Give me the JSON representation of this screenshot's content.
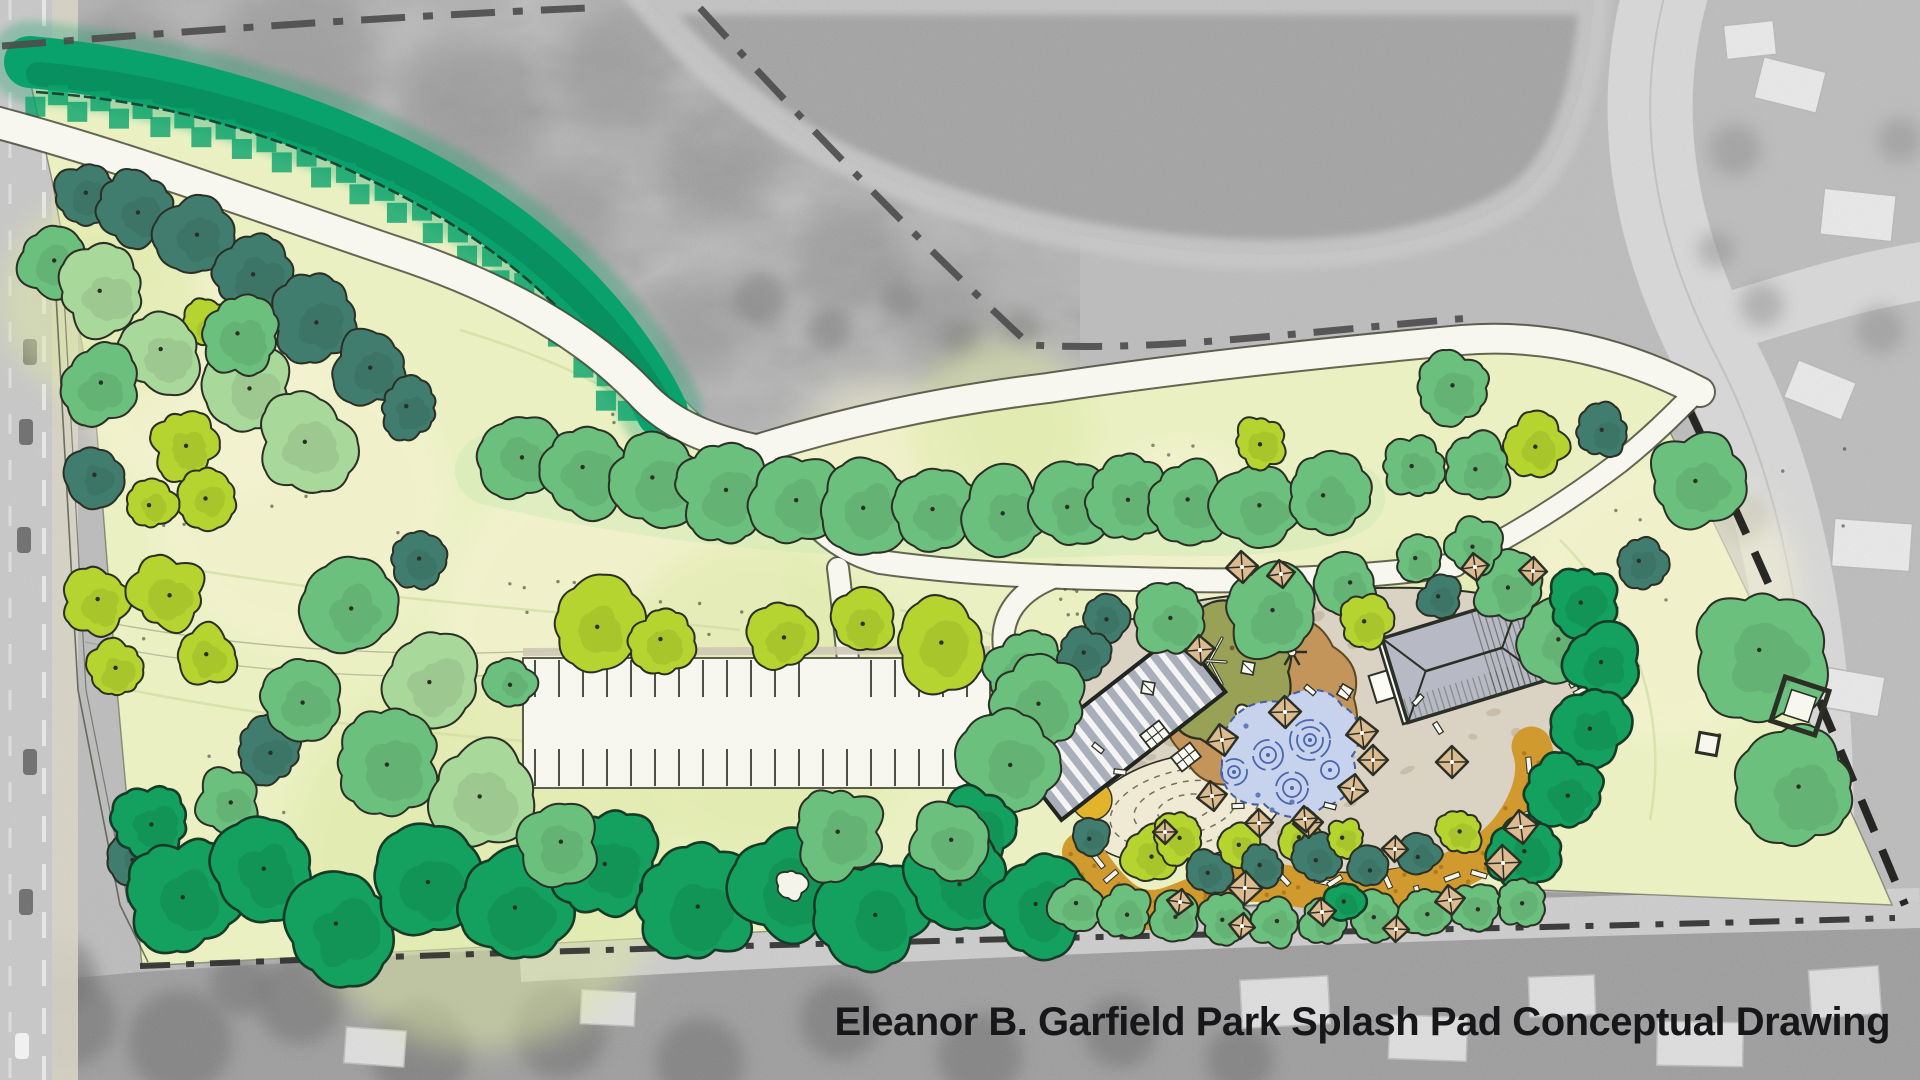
{
  "title": {
    "text": "Eleanor B. Garfield Park Splash Pad Conceptual Drawing"
  },
  "palette": {
    "base_gray": "#bcbcbc",
    "forest_gray": "#b0b0b0",
    "pond_gray": "#a3a3a3",
    "shore_gray": "#c9c9c9",
    "road_gray": "#d8d8d8",
    "road_left": "#c8c8c8",
    "sidewalk": "#d9d6c6",
    "bottom_gray": "#9c9c9c",
    "gray_tree": "#6f6f6f",
    "house_gray": "#e9e9e9",
    "house_edge": "#b8b8b8",
    "lawn": "#eaf0c2",
    "lawn_light": "#f5f3d4",
    "lawn_wash": "#dce8a4",
    "lawn_line": "#cfdd9f",
    "ink": "#2b2f25",
    "boundary_gray": "#4b4b4b",
    "shore_dash": "#7e7e7e",
    "path_fill": "#f7f7ef",
    "path_edge": "#4b4e3c",
    "emerald": "#0aa26c",
    "emerald_dark": "#067a51",
    "tree_light": "#a9d89b",
    "tree_medium": "#6cc07d",
    "tree_deep": "#14a05e",
    "tree_teal": "#417d6e",
    "tree_chartreuse": "#b5d430",
    "plaza_tan": "#dad2c2",
    "plaza_dot": "#c2b8a4",
    "sand_brown": "#c3955a",
    "mound_olive": "#99a156",
    "mulch_orange": "#d09a2e",
    "mulch_dot": "#a8771a",
    "amber_patch": "#e3b32b",
    "water_blue": "#c7d2ec",
    "water_line": "#4a67ad",
    "umbrella_tan": "#dcbb90",
    "table_white": "#fbfbf5",
    "roof_gray": "#b7bac4",
    "pergola_gray": "#a9aebb",
    "contour_cream": "#f0ead4",
    "contour_line": "#70745c",
    "title_color": "#17171a"
  },
  "map": {
    "canvas": {
      "w": 1920,
      "h": 1080
    },
    "pond": {
      "d": "M646,0 C690,55 745,105 820,148 C930,205 1060,240 1200,252 C1330,262 1445,245 1515,200 C1562,168 1588,95 1594,0 Z"
    },
    "lawn": {
      "d": "M30,80 C180,92 330,140 455,205 C545,252 615,315 668,382 C700,420 730,440 762,452 C880,412 960,396 1048,386 C1180,364 1320,354 1462,340 C1560,332 1642,362 1706,394 L1668,428 C1760,620 1830,760 1892,905 L1540,890 C1100,910 560,946 142,966 L118,700 L96,420 L52,180 Z"
    },
    "emerald_band": {
      "core": "M30,62 C160,74 290,110 400,165 C495,212 560,268 610,330 C635,362 652,390 662,412",
      "squiggle": "M36,92 C180,102 300,142 402,196 C492,243 552,295 600,355 C622,382 638,402 650,420"
    },
    "boundaries": [
      {
        "d": "M2,46 C200,30 400,16 588,8",
        "w": 7,
        "dash": "44 18 10 18",
        "c": "#4b4b4b",
        "o": 0.9
      },
      {
        "d": "M700,8 C810,130 940,262 1030,345 C1160,352 1300,332 1470,318",
        "w": 7,
        "dash": "40 18 8 18",
        "c": "#4b4b4b",
        "o": 0.9
      },
      {
        "d": "M1000,386 L1262,362",
        "w": 5,
        "dash": "46 16 10 16",
        "c": "#7e7e7e",
        "o": 0.8
      },
      {
        "d": "M1687,405 C1760,560 1820,700 1905,905",
        "w": 8,
        "dash": "34 20",
        "c": "#1d1f1a",
        "o": 0.95
      },
      {
        "d": "M140,966 C500,952 800,944 1100,937 C1400,930 1700,924 1895,918",
        "w": 6,
        "dash": "30 16 8 16",
        "c": "#2e2e2e",
        "o": 0.9
      },
      {
        "d": "M56,295 L78,690 L120,905 L148,962",
        "w": 1.6,
        "dash": "",
        "c": "#4b4e3c",
        "o": 0.75
      },
      {
        "d": "M64,295 L86,690 L128,903",
        "w": 1.2,
        "dash": "",
        "c": "#4b4e3c",
        "o": 0.6
      }
    ],
    "paths": [
      {
        "d": "M-5,122 C130,158 270,210 395,252 C505,288 585,335 640,392 C665,420 700,438 755,450",
        "w": 30
      },
      {
        "d": "M755,450 C850,420 950,400 1048,388 C1180,368 1330,352 1462,340 C1560,332 1642,362 1700,392",
        "w": 28
      },
      {
        "d": "M755,450 C795,505 825,548 880,562 C980,576 1080,578 1180,580 C1280,582 1380,576 1455,565",
        "w": 22
      },
      {
        "d": "M1455,565 C1520,532 1570,500 1620,462 C1650,438 1672,416 1690,398",
        "w": 20
      },
      {
        "d": "M838,568 C842,600 845,630 848,660",
        "w": 20
      },
      {
        "d": "M1058,576 C1018,590 1000,616 1004,648 C1008,682 1024,706 1050,724",
        "w": 20
      }
    ],
    "parking": {
      "x": 523,
      "y": 658,
      "w": 467,
      "h": 130,
      "tick_step": 24,
      "top_ticks": [
        660,
        697
      ],
      "bottom_ticks": [
        749,
        786
      ],
      "entry_gap": [
        806,
        852
      ]
    },
    "plaza": {
      "d": "M1140,618 C1180,600 1240,592 1310,592 C1390,585 1470,585 1530,605 C1566,625 1582,665 1578,710 C1570,762 1540,802 1498,832 C1448,862 1388,876 1328,872 C1258,880 1188,866 1140,838 C1092,810 1060,768 1054,726 C1050,692 1062,660 1086,640 C1102,626 1120,620 1140,618 Z"
    },
    "contour_mound": {
      "cx": 1185,
      "cy": 808,
      "rx": 100,
      "ry": 52,
      "rot": -12,
      "rings": [
        [
          76,
          38
        ],
        [
          52,
          26
        ],
        [
          28,
          13
        ]
      ]
    },
    "mulch": {
      "pts": [
        [
          1082,
          852
        ],
        [
          1110,
          895
        ],
        [
          1150,
          915
        ],
        [
          1200,
          895
        ],
        [
          1240,
          880
        ],
        [
          1290,
          885
        ],
        [
          1340,
          895
        ],
        [
          1400,
          890
        ],
        [
          1455,
          872
        ],
        [
          1500,
          845
        ],
        [
          1528,
          805
        ],
        [
          1538,
          765
        ],
        [
          1525,
          728
        ]
      ],
      "w": 40
    },
    "amber_patch": {
      "x": 1092,
      "y": 800,
      "r": 20
    },
    "sand": {
      "cx": 1262,
      "cy": 698,
      "r": 92
    },
    "olive": {
      "cx": 1222,
      "cy": 672,
      "r": 70
    },
    "water": {
      "d": "M1222,744 C1226,714 1252,698 1280,702 C1302,684 1330,686 1342,706 C1360,714 1366,738 1352,756 C1362,780 1348,802 1324,806 C1306,822 1280,820 1264,804 C1240,808 1220,790 1222,768 Z",
      "swirls": [
        [
          1310,
          740,
          20
        ],
        [
          1268,
          755,
          15
        ],
        [
          1234,
          772,
          13
        ],
        [
          1292,
          788,
          16
        ],
        [
          1330,
          770,
          9
        ]
      ],
      "drops": [
        [
          1258,
          795
        ],
        [
          1272,
          810
        ],
        [
          1292,
          802
        ],
        [
          1306,
          814
        ],
        [
          1246,
          726
        ]
      ]
    },
    "pergola": {
      "x": 1016,
      "y": 688,
      "w": 208,
      "h": 76,
      "rot": -38,
      "cx": 1120,
      "cy": 726
    },
    "building": {
      "cx": 1462,
      "cy": 660,
      "wall": [
        1387,
        616,
        150,
        88
      ],
      "roof": [
        1392,
        616,
        145,
        88
      ],
      "porch": [
        1368,
        648,
        24,
        28
      ],
      "ridge": [
        1424,
        660,
        1504,
        660
      ],
      "rot": -17
    },
    "boardwalks": [
      {
        "x": 1568,
        "y": 606,
        "rot": 28,
        "n": 7,
        "len": 30,
        "gap": 9
      },
      {
        "x": 1592,
        "y": 672,
        "rot": 62,
        "n": 5,
        "len": 26,
        "gap": 9
      }
    ],
    "trees": [
      [
        85,
        195,
        30,
        "T"
      ],
      [
        138,
        210,
        35,
        "T"
      ],
      [
        196,
        235,
        38,
        "T"
      ],
      [
        256,
        276,
        40,
        "T"
      ],
      [
        316,
        320,
        40,
        "T"
      ],
      [
        371,
        367,
        36,
        "T"
      ],
      [
        409,
        408,
        28,
        "T"
      ],
      [
        52,
        262,
        34,
        "M"
      ],
      [
        102,
        292,
        42,
        "L"
      ],
      [
        209,
        324,
        25,
        "C"
      ],
      [
        162,
        352,
        40,
        "L"
      ],
      [
        248,
        388,
        44,
        "L"
      ],
      [
        306,
        442,
        46,
        "L"
      ],
      [
        98,
        385,
        38,
        "M"
      ],
      [
        240,
        336,
        38,
        "M"
      ],
      [
        185,
        445,
        32,
        "C"
      ],
      [
        208,
        497,
        28,
        "C"
      ],
      [
        152,
        504,
        24,
        "C"
      ],
      [
        95,
        477,
        28,
        "T"
      ],
      [
        97,
        602,
        32,
        "C"
      ],
      [
        167,
        593,
        36,
        "C"
      ],
      [
        115,
        670,
        28,
        "C"
      ],
      [
        205,
        655,
        30,
        "C"
      ],
      [
        268,
        752,
        32,
        "T"
      ],
      [
        300,
        700,
        40,
        "M"
      ],
      [
        350,
        608,
        44,
        "M"
      ],
      [
        418,
        560,
        26,
        "T"
      ],
      [
        432,
        680,
        48,
        "L"
      ],
      [
        388,
        762,
        50,
        "M"
      ],
      [
        135,
        858,
        26,
        "T"
      ],
      [
        480,
        795,
        52,
        "L"
      ],
      [
        520,
        455,
        40,
        "M"
      ],
      [
        585,
        470,
        46,
        "M"
      ],
      [
        655,
        480,
        44,
        "M"
      ],
      [
        725,
        492,
        46,
        "M"
      ],
      [
        795,
        500,
        44,
        "M"
      ],
      [
        865,
        505,
        46,
        "M"
      ],
      [
        935,
        510,
        44,
        "M"
      ],
      [
        1005,
        512,
        42,
        "M"
      ],
      [
        1070,
        505,
        40,
        "M"
      ],
      [
        1128,
        498,
        38,
        "M"
      ],
      [
        1190,
        502,
        40,
        "M"
      ],
      [
        1258,
        506,
        42,
        "M"
      ],
      [
        1326,
        497,
        40,
        "M"
      ],
      [
        1260,
        442,
        25,
        "C"
      ],
      [
        1413,
        467,
        30,
        "M"
      ],
      [
        1452,
        388,
        34,
        "M"
      ],
      [
        511,
        682,
        24,
        "M"
      ],
      [
        595,
        625,
        44,
        "C"
      ],
      [
        663,
        641,
        30,
        "C"
      ],
      [
        782,
        636,
        34,
        "C"
      ],
      [
        862,
        622,
        32,
        "C"
      ],
      [
        940,
        642,
        44,
        "C"
      ],
      [
        1025,
        672,
        40,
        "M"
      ],
      [
        1535,
        446,
        31,
        "C"
      ],
      [
        1603,
        432,
        25,
        "T"
      ],
      [
        1478,
        467,
        33,
        "M"
      ],
      [
        1697,
        481,
        46,
        "M"
      ],
      [
        1641,
        562,
        25,
        "T"
      ],
      [
        1762,
        652,
        64,
        "M"
      ],
      [
        1800,
        788,
        56,
        "M"
      ],
      [
        1560,
        641,
        38,
        "M"
      ],
      [
        1508,
        588,
        33,
        "M"
      ],
      [
        1172,
        618,
        36,
        "M"
      ],
      [
        1272,
        611,
        46,
        "M"
      ],
      [
        1348,
        585,
        29,
        "M"
      ],
      [
        1366,
        622,
        26,
        "C"
      ],
      [
        1440,
        598,
        21,
        "T"
      ],
      [
        1418,
        561,
        23,
        "M"
      ],
      [
        1475,
        546,
        27,
        "M"
      ],
      [
        1105,
        618,
        23,
        "T"
      ],
      [
        1082,
        655,
        25,
        "T"
      ],
      [
        1040,
        702,
        44,
        "M"
      ],
      [
        1008,
        762,
        47,
        "M"
      ],
      [
        975,
        828,
        40,
        "D"
      ],
      [
        1582,
        601,
        34,
        "D"
      ],
      [
        1601,
        661,
        36,
        "D"
      ],
      [
        1592,
        727,
        36,
        "D"
      ],
      [
        1565,
        793,
        36,
        "D"
      ],
      [
        1525,
        853,
        36,
        "D"
      ],
      [
        152,
        822,
        36,
        "D"
      ],
      [
        228,
        801,
        31,
        "M"
      ],
      [
        185,
        896,
        54,
        "D"
      ],
      [
        262,
        868,
        50,
        "D"
      ],
      [
        338,
        926,
        56,
        "D"
      ],
      [
        425,
        881,
        52,
        "D"
      ],
      [
        515,
        906,
        56,
        "D"
      ],
      [
        605,
        862,
        50,
        "D"
      ],
      [
        695,
        906,
        56,
        "D"
      ],
      [
        788,
        883,
        54,
        "D"
      ],
      [
        875,
        912,
        52,
        "D"
      ],
      [
        958,
        882,
        50,
        "D"
      ],
      [
        1038,
        905,
        48,
        "D"
      ],
      [
        558,
        842,
        40,
        "M"
      ],
      [
        838,
        832,
        44,
        "M"
      ],
      [
        950,
        842,
        38,
        "M"
      ],
      [
        1092,
        838,
        18,
        "T"
      ],
      [
        1150,
        855,
        28,
        "C"
      ],
      [
        1178,
        838,
        24,
        "C"
      ],
      [
        1208,
        872,
        22,
        "T"
      ],
      [
        1240,
        845,
        20,
        "C"
      ],
      [
        1262,
        868,
        20,
        "T"
      ],
      [
        1300,
        840,
        20,
        "C"
      ],
      [
        1318,
        858,
        22,
        "T"
      ],
      [
        1345,
        838,
        18,
        "C"
      ],
      [
        1368,
        868,
        20,
        "T"
      ],
      [
        1420,
        855,
        20,
        "T"
      ],
      [
        1460,
        832,
        22,
        "C"
      ],
      [
        1075,
        905,
        26,
        "M"
      ],
      [
        1125,
        912,
        26,
        "M"
      ],
      [
        1175,
        918,
        24,
        "M"
      ],
      [
        1225,
        920,
        24,
        "M"
      ],
      [
        1275,
        922,
        24,
        "M"
      ],
      [
        1325,
        920,
        24,
        "M"
      ],
      [
        1375,
        916,
        24,
        "M"
      ],
      [
        1425,
        912,
        24,
        "M"
      ],
      [
        1475,
        908,
        24,
        "M"
      ],
      [
        1520,
        902,
        24,
        "M"
      ],
      [
        1345,
        901,
        19,
        "D"
      ]
    ],
    "umbrellas": [
      [
        1242,
        567,
        16
      ],
      [
        1281,
        574,
        14
      ],
      [
        1200,
        650,
        15
      ],
      [
        1285,
        712,
        16
      ],
      [
        1222,
        740,
        16
      ],
      [
        1212,
        796,
        15
      ],
      [
        1362,
        733,
        16
      ],
      [
        1373,
        760,
        15
      ],
      [
        1353,
        789,
        15
      ],
      [
        1308,
        823,
        15
      ],
      [
        1259,
        823,
        14
      ],
      [
        1452,
        762,
        16
      ],
      [
        1521,
        827,
        17
      ],
      [
        1503,
        863,
        18
      ],
      [
        1475,
        567,
        14
      ],
      [
        1533,
        571,
        14
      ],
      [
        1245,
        888,
        17
      ],
      [
        1305,
        819,
        13
      ],
      [
        1165,
        832,
        12
      ],
      [
        1395,
        849,
        13
      ],
      [
        1450,
        900,
        15
      ],
      [
        1180,
        902,
        13
      ],
      [
        1322,
        912,
        14
      ],
      [
        1396,
        929,
        13
      ],
      [
        1242,
        926,
        13
      ]
    ],
    "tables": [
      [
        1155,
        735
      ],
      [
        1186,
        757
      ]
    ],
    "small_tables": [
      [
        1148,
        688
      ],
      [
        1345,
        692
      ],
      [
        1248,
        668
      ]
    ],
    "benches": [
      [
        1120,
        772
      ],
      [
        1098,
        748
      ],
      [
        1238,
        806
      ],
      [
        1330,
        806
      ],
      [
        1418,
        700
      ],
      [
        1438,
        728
      ],
      [
        1310,
        690
      ]
    ],
    "shade_squares": {
      "big": [
        1800,
        706,
        46,
        18
      ],
      "small": [
        1708,
        744,
        20,
        10
      ]
    },
    "kidney_pond": [
      792,
      886,
      15
    ],
    "houses_right": [
      [
        1790,
        85,
        64,
        42,
        14
      ],
      [
        1858,
        215,
        72,
        46,
        6
      ],
      [
        1820,
        390,
        62,
        40,
        22
      ],
      [
        1872,
        545,
        78,
        48,
        4
      ],
      [
        1852,
        692,
        60,
        40,
        10
      ],
      [
        1750,
        40,
        50,
        34,
        -6
      ]
    ],
    "houses_bottom": [
      [
        1285,
        1002,
        88,
        48,
        -3
      ],
      [
        1428,
        1038,
        78,
        44,
        2
      ],
      [
        1562,
        996,
        66,
        40,
        -2
      ],
      [
        1700,
        1044,
        86,
        44,
        1
      ],
      [
        1845,
        992,
        70,
        48,
        -4
      ],
      [
        375,
        1047,
        60,
        36,
        4
      ],
      [
        608,
        1008,
        54,
        34,
        3
      ]
    ],
    "cars_left": [
      [
        30,
        352
      ],
      [
        26,
        432
      ],
      [
        24,
        540
      ],
      [
        30,
        762
      ],
      [
        26,
        902
      ]
    ],
    "road_right": {
      "d": "M1672,-30 C1630,100 1650,230 1718,360 C1775,470 1800,600 1808,720 C1815,840 1812,960 1808,1090",
      "w": 85
    },
    "road_branch": {
      "d": "M1700,330 C1800,300 1860,280 1930,270",
      "w": 58
    },
    "bottom_road": {
      "d": "M520,962 C900,940 1300,922 1920,908",
      "w": 40
    },
    "bottom_strip": {
      "d": "M0,985 L140,972 L560,946 L1100,912 L1540,892 L1895,900 L1920,902 L1920,1080 L0,1080 Z"
    }
  }
}
